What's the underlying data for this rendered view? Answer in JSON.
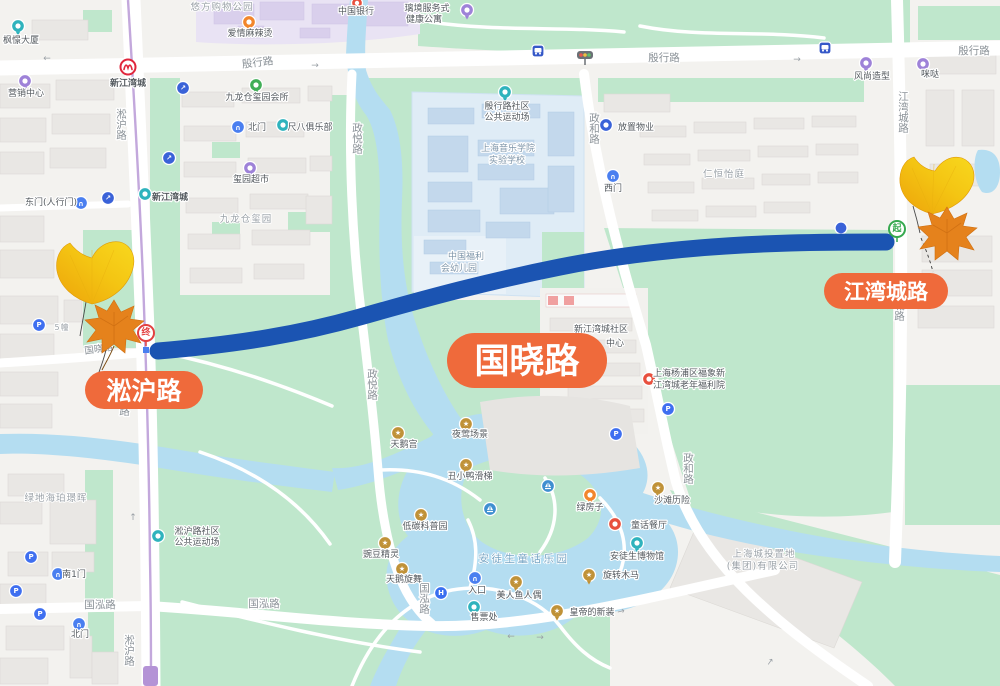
{
  "colors": {
    "route": "#1b54b2",
    "pill": "#ef6a3b",
    "park_green": "#bfe7cc",
    "water": "#b4ddf1",
    "metro_line": "#c3a8dc"
  },
  "pills": {
    "songhu": "淞沪路",
    "guoxiao": "国晓路",
    "jiangwancheng": "江湾城路"
  },
  "markers": {
    "start": "起",
    "end": "终"
  },
  "metro": {
    "station": "新江湾城"
  },
  "roads": {
    "yinhang": "殷行路",
    "songhu": "淞沪路",
    "jiangwancheng": "江湾城路",
    "zhengyue": "政悦路",
    "zhenghe": "政和路",
    "guohong": "国泓路",
    "guoxiao": "国晓路"
  },
  "icons": {
    "parking": "P",
    "hospital": "H",
    "star": "★",
    "entrance_arrow": "↗",
    "gate": "∩",
    "arrow_left": "←",
    "arrow_right": "→",
    "arrow_up": "↑"
  },
  "labels": {
    "fengjing_tower": "枫憬大厦",
    "marketing_center": "营销中心",
    "youfang_mall": "悠方购物公园",
    "aiqing_malatang": "爱情麻辣烫",
    "bank_of_china": "中国银行",
    "apartment_line1": "璃境服务式",
    "apartment_line2": "健康公寓",
    "jiulongcang_clubhouse": "九龙仓玺园会所",
    "north_gate_top": "北门",
    "chiba_club": "尺八俱乐部",
    "xiyuan_market": "玺园超市",
    "jiulongcang_xiyuan": "九龙仓玺园",
    "east_gate": "东门(人行门)",
    "xinjiangwancheng_poi": "新江湾城",
    "sports_ground_yinhang_line1": "殷行路社区",
    "sports_ground_yinhang_line2": "公共运动场",
    "music_school_line1": "上海音乐学院",
    "music_school_line2": "实验学校",
    "kindergarten_line1": "中国福利",
    "kindergarten_line2": "会幼儿园",
    "fangzhi_property": "放置物业",
    "west_gate": "西门",
    "renheng_yiting": "仁恒怡庭",
    "fengshang_salon": "风尚造型",
    "mida": "咪哒",
    "community_center_line1": "新江湾城社区",
    "community_center_line2": "中心",
    "elder_home_line1": "上海杨浦区福象新",
    "elder_home_line2": "江湾城老年福利院",
    "building5": "5幢",
    "lvdi_haipo": "绿地海珀璟晖",
    "south_gate1": "南1门",
    "north_gate_bottom": "北门",
    "sports_ground_songhu_line1": "淞沪路社区",
    "sports_ground_songhu_line2": "公共运动场",
    "swan_palace": "天鹅宫",
    "nightingale_scene": "夜莺场景",
    "ugly_duckling_slide": "丑小鸭滑梯",
    "low_carbon_garden": "低碳科普园",
    "pea_sprite": "豌豆精灵",
    "swan_dance": "天鹅旋舞",
    "andersen_park": "安徒生童话乐园",
    "entrance": "入口",
    "ticket_office": "售票处",
    "mermaid_figure": "美人鱼人偶",
    "emperors_new_clothes": "皇帝的新装",
    "carousel": "旋转木马",
    "andersen_museum": "安徒生博物馆",
    "beach_adventure": "沙滩历险",
    "green_house": "绿房子",
    "fairytale_restaurant": "童话餐厅",
    "chengtou_line1": "上海城投置地",
    "chengtou_line2": "(集团)有限公司"
  }
}
